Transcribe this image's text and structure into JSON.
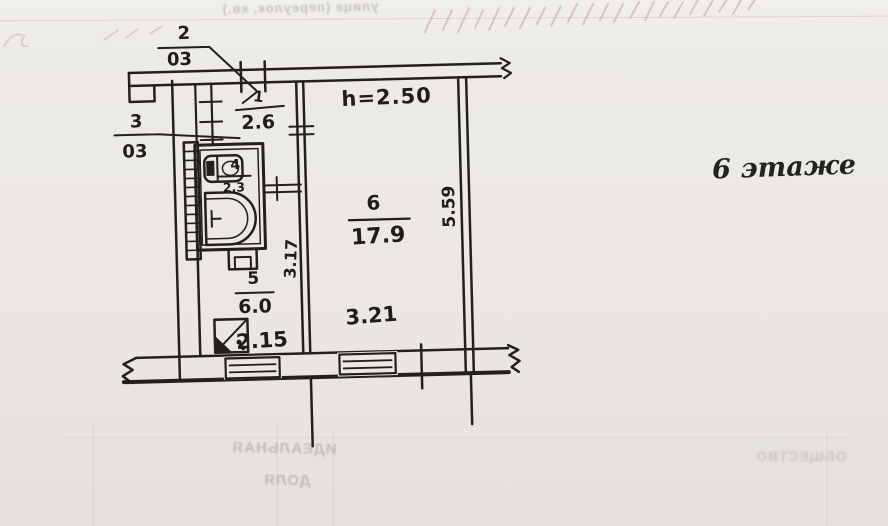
{
  "drawing": {
    "floor_label": "6 этаже",
    "ceiling_height": "h=2.50",
    "rooms": [
      {
        "id": "room-1-hall",
        "number": "1",
        "area": "2.6"
      },
      {
        "id": "room-2-closet",
        "number": "2",
        "area": "03"
      },
      {
        "id": "room-3-closet",
        "number": "3",
        "area": "03"
      },
      {
        "id": "room-4-bath",
        "number": "4",
        "area": "2.3"
      },
      {
        "id": "room-5-kitchen",
        "number": "5",
        "area": "6.0"
      },
      {
        "id": "room-6-living",
        "number": "6",
        "area": "17.9"
      }
    ],
    "dimensions": {
      "kitchen_width": "2.15",
      "kitchen_depth": "3.17",
      "living_width": "3.21",
      "living_depth": "5.59"
    }
  },
  "bleedthrough": {
    "top_form_text": "улице (переулок, кв.)",
    "center_line1": "ИДЕАЛЬНАЯ",
    "center_line2": "ДОЛЯ",
    "right_text": "ОБЩЕСТВО"
  },
  "icons": {
    "bathtub-icon": "css-shape",
    "sink-icon": "css-shape",
    "toilet-icon": "css-shape",
    "stove-icon": "css-shape",
    "window-symbol": "css-shape",
    "wall-break-symbol": "zigzag-shape",
    "vent-shaft-hatch": "ladder-hatch"
  },
  "colors": {
    "ink": "#23201c",
    "paper": "#ebe8e3",
    "bleed_text": "#c1beb9",
    "pink_pencil": "#ba8892"
  }
}
